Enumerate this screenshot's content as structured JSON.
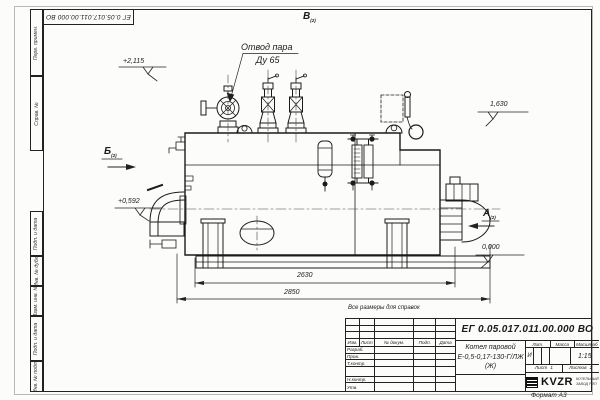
{
  "drawing": {
    "doc_number": "ЕГ 0.05.017.011.00.000  ВО",
    "reference_note": "Все размеры для справок",
    "format_note": "Формат А3"
  },
  "labels": {
    "steam_outlet": {
      "line1": "Отвод пара",
      "line2": "Ду 65"
    },
    "elevations": {
      "e1": "+2,115",
      "e2": "+0,592",
      "e3": "1,630",
      "e4": "0,000"
    },
    "views": {
      "b": "Б",
      "v": "В",
      "a": "А",
      "sub": "(2)"
    },
    "dimensions": {
      "length_inner": "2630",
      "length_overall": "2850"
    }
  },
  "margin_columns": [
    "Перв. примен.",
    "Справ. №",
    "Подп. и дата",
    "Инв. № дубл.",
    "Взам. инв. №",
    "Подп. и дата",
    "Инв. № подл."
  ],
  "titleblock": {
    "change_header": [
      "Изм.",
      "Лист",
      "№ докум.",
      "Подп.",
      "Дата"
    ],
    "sig_rows": [
      "Разраб.",
      "Пров.",
      "Т.контр.",
      "",
      "Н.контр.",
      "Утв."
    ],
    "doc_number": "ЕГ 0.05.017.011.00.000  ВО",
    "product_line1": "Котел паровой",
    "product_line2": "Е-0,5-0,17-130-Г/ЛЖ (Ж)",
    "lit_label": "Лит.",
    "lit_value": "И",
    "mass_label": "Масса",
    "scale_label": "Масштаб",
    "scale_value": "1:15",
    "sheet_label": "Лист",
    "sheet_no": "1",
    "sheets_label": "Листов",
    "sheets_total": "2",
    "logo": "KVZR",
    "org_line1": "КОТЕЛЬНЫЙ",
    "org_line2": "ЗАВОД РЭП"
  }
}
